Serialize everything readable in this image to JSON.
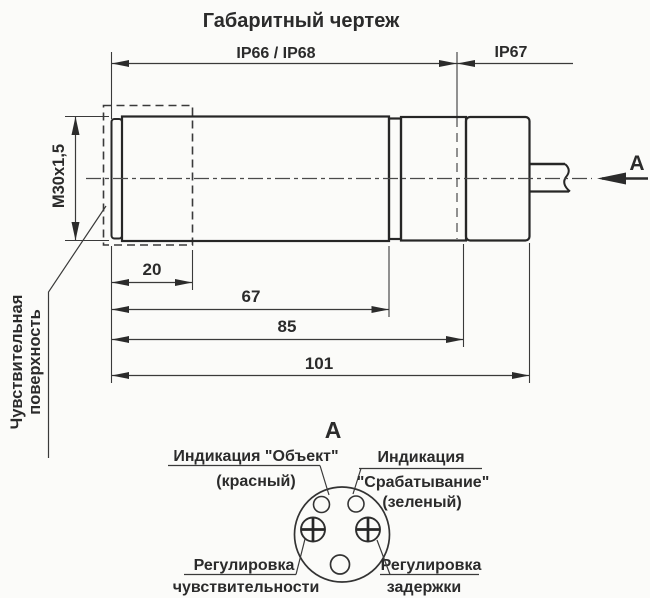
{
  "title": "Габаритный чертеж",
  "colors": {
    "line": "#2b2b2b",
    "background": "#fbfbf9"
  },
  "main_view": {
    "ip_rating_body": "IP66 / IP68",
    "ip_rating_rear": "IP67",
    "thread": "М30х1,5",
    "sensitive_surface": {
      "line1": "Чувствительная",
      "line2": "поверхность"
    },
    "dims": {
      "d20": "20",
      "d67": "67",
      "d85": "85",
      "d101": "101"
    },
    "section_arrow_label": "А"
  },
  "view_a": {
    "title": "А",
    "object_indicator": {
      "line1": "Индикация \"Объект\"",
      "line2": "(красный)"
    },
    "trigger_indicator": {
      "line1": "Индикация",
      "line2": "\"Срабатывание\"",
      "line3": "(зеленый)"
    },
    "sensitivity_control": {
      "line1": "Регулировка",
      "line2": "чувствительности"
    },
    "delay_control": {
      "line1": "Регулировка",
      "line2": "задержки"
    }
  }
}
